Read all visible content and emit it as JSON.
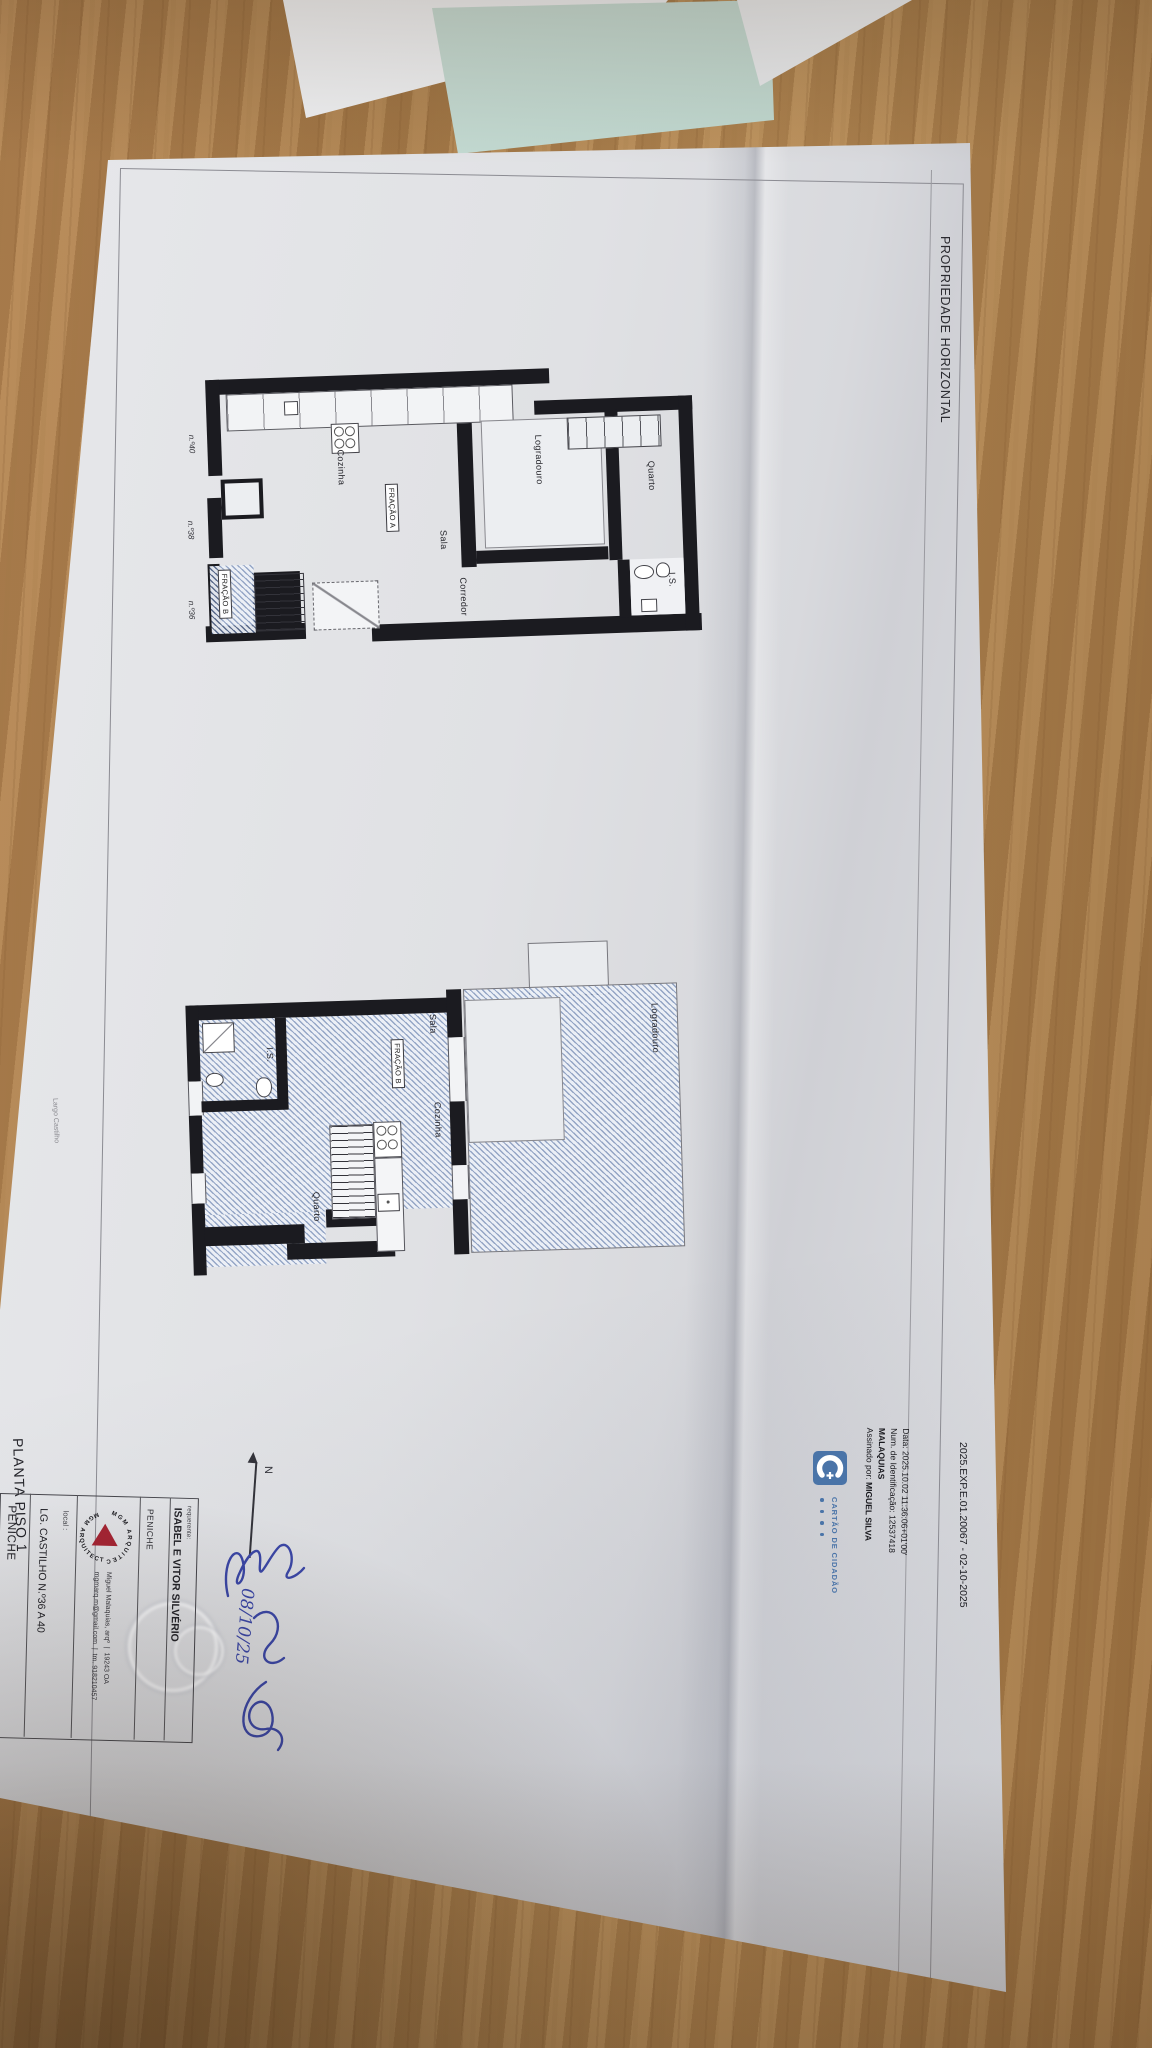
{
  "header": {
    "title": "PROPRIEDADE HORIZONTAL",
    "doc_ref": "2025.EXP.E.01.20067 - 02-10-2025"
  },
  "digital_signature": {
    "signed_by_prefix": "Assinado por: ",
    "name_line1": "MIGUEL SILVA",
    "name_line2": "MALAQUIAS",
    "id_line": "Num. de Identificação: 12537418",
    "date_line": "Data: 2025.10.02 11:36:06+01'00'",
    "card_label": "CARTÃO DE CIDADÃO"
  },
  "plan0": {
    "title": "PLANTA PISO 0",
    "street": "Largo Castilho",
    "numbers": {
      "n40": "n.º40",
      "n38": "n.º38",
      "n36": "n.º36"
    },
    "rooms": {
      "cozinha": "Cozinha",
      "sala": "Sala",
      "corredor": "Corredor",
      "is": "I.S.",
      "quarto": "Quarto",
      "logradouro": "Logradouro"
    },
    "fracao_a": "FRAÇÃO A",
    "fracao_b": "FRAÇÃO B"
  },
  "plan1": {
    "title": "PLANTA PISO 1",
    "street": "Largo Castilho",
    "rooms": {
      "is": "I.S.",
      "sala": "Sala",
      "cozinha": "Cozinha",
      "quarto": "Quarto",
      "logradouro": "Logradouro"
    },
    "fracao_b": "FRAÇÃO B"
  },
  "north_label": "N",
  "title_block": {
    "requerente_label": "requerente:",
    "requerente_name": "ISABEL E VITOR SILVÉRIO",
    "requerente_city": "PENICHE",
    "logo_text": "MGM ARQUITECTURA",
    "architect_name": "Miguel Malaquias, arqº",
    "architect_reg": "19243 OA",
    "architect_email": "mgmarq.m@gmail.com",
    "architect_phone": "tm. 918210457",
    "separator": "|",
    "local_label": "local :",
    "local_value": "LG. CASTILHO N.º36 A 40",
    "local_city": "PENICHE"
  },
  "handwriting": {
    "date": "08/10/25"
  },
  "colors": {
    "wood": "#a97c47",
    "paper": "#dfe0e4",
    "teal_sheet": "#c6dbd4",
    "wall": "#1b1b20",
    "hatch_blue": "#748cb8",
    "card_blue": "#4a74a8",
    "logo_red": "#a32433",
    "ink_blue": "#3a46a5"
  }
}
